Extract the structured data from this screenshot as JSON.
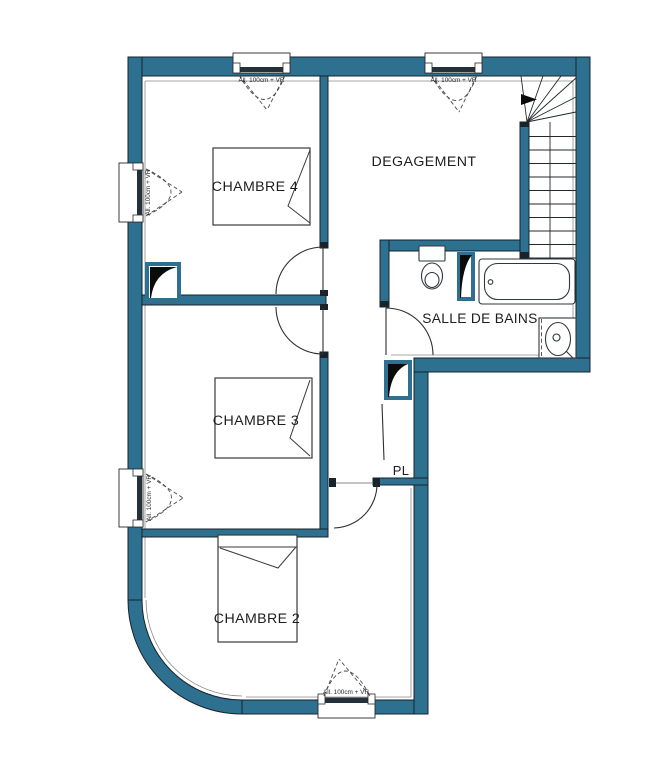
{
  "colors": {
    "wall": "#2d7090",
    "outline": "#17242b",
    "glazing": "#22313b",
    "fixture": "#32373b",
    "dash": "#4a4a4a",
    "text": "#1d1d1d",
    "liner": "#8a8a8a",
    "duct": "#0b0b0b",
    "bg": "#ffffff"
  },
  "rooms": {
    "chambre4": {
      "label": "CHAMBRE 4"
    },
    "chambre3": {
      "label": "CHAMBRE 3"
    },
    "chambre2": {
      "label": "CHAMBRE 2"
    },
    "degagement": {
      "label": "DEGAGEMENT"
    },
    "salle_de_bains": {
      "label": "SALLE DE BAINS"
    },
    "placard": {
      "label": "PL"
    }
  },
  "windows": [
    {
      "position": "top-left",
      "label": "All. 100cm + VR"
    },
    {
      "position": "top-center",
      "label": "All. 100cm + VR"
    },
    {
      "position": "left-upper",
      "label": "All. 100cm + VR"
    },
    {
      "position": "left-lower",
      "label": "All. 100cm + VR"
    },
    {
      "position": "bottom",
      "label": "All. 100cm + VR"
    }
  ]
}
